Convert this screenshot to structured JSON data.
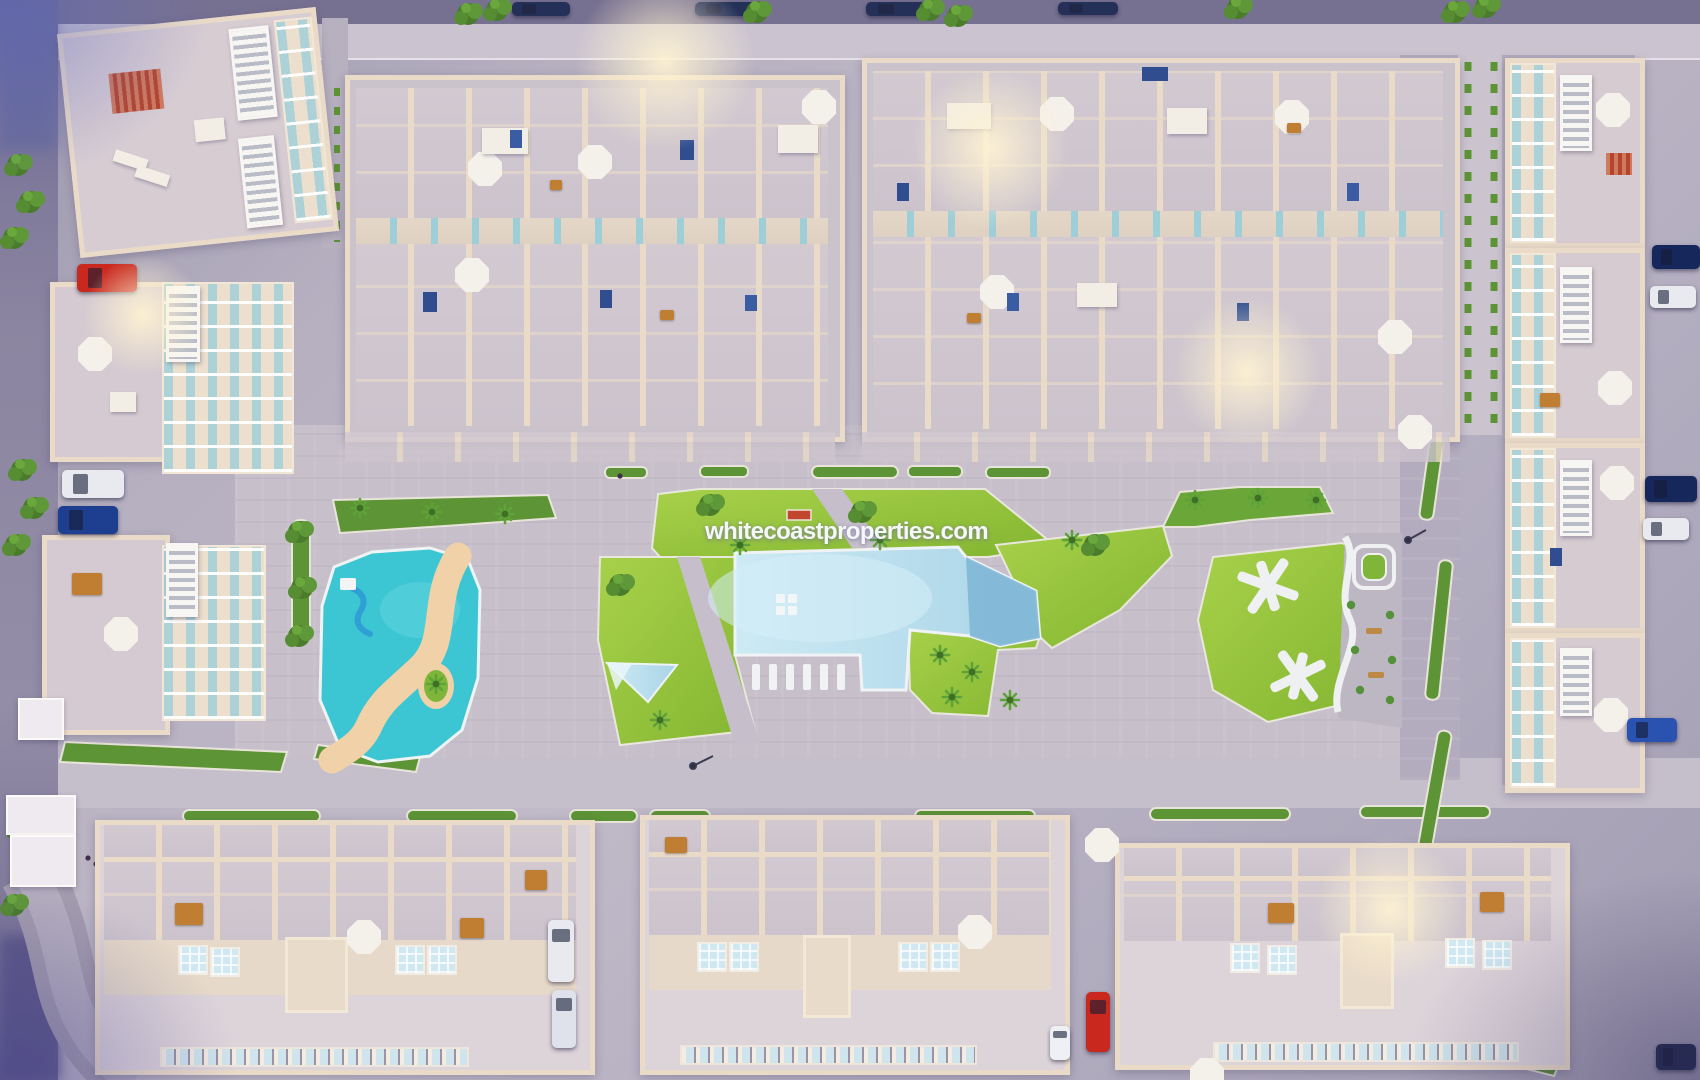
{
  "watermark": {
    "text": "whitecoastproperties.com"
  },
  "scene": {
    "type": "aerial-3d-render-of-residential-development",
    "time_of_day": "dusk",
    "buildings": {
      "top_terrace_blocks": 2,
      "bottom_apartment_buildings": 3,
      "left_villas": 3,
      "right_townhouse_rows": 4
    },
    "amenities": [
      "main-swimming-pool",
      "kids-pool-lazy-river",
      "water-slide",
      "pool-entry-steps",
      "sun-lounger-deck",
      "lawn-gardens",
      "palm-trees",
      "x-shaped-garden-paths",
      "hedge-planters"
    ],
    "vehicles": [
      {
        "color": "#c8281e",
        "type": "car",
        "location": "top-left-street"
      },
      {
        "color": "#e9eaef",
        "type": "car",
        "location": "left-street"
      },
      {
        "color": "#1e3f8f",
        "type": "car",
        "location": "left-street"
      },
      {
        "color": "#e9eaef",
        "type": "car",
        "location": "street-between-bottom-left-buildings"
      },
      {
        "color": "#c8281e",
        "type": "car",
        "location": "street-between-bottom-right-buildings"
      },
      {
        "color": "#e9eaef",
        "type": "van",
        "location": "street-between-bottom-right-buildings"
      },
      {
        "color": "#16275c",
        "type": "car",
        "location": "right-street"
      },
      {
        "color": "#2a52b0",
        "type": "car",
        "location": "right-street"
      }
    ],
    "palette": {
      "pavement": "#c7c0cb",
      "street": "#8f89a1",
      "building_wall": "#eadbc8",
      "roof_floor": "#cbc3cc",
      "lawn": "#98c43c",
      "hedge": "#5d9435",
      "main_pool": "#aed7e6",
      "kids_pool": "#3cc5d3",
      "sand_path": "#f1d1a8",
      "watermark_white": "#fafbfd",
      "glow_warm": "#fff3d2"
    }
  }
}
